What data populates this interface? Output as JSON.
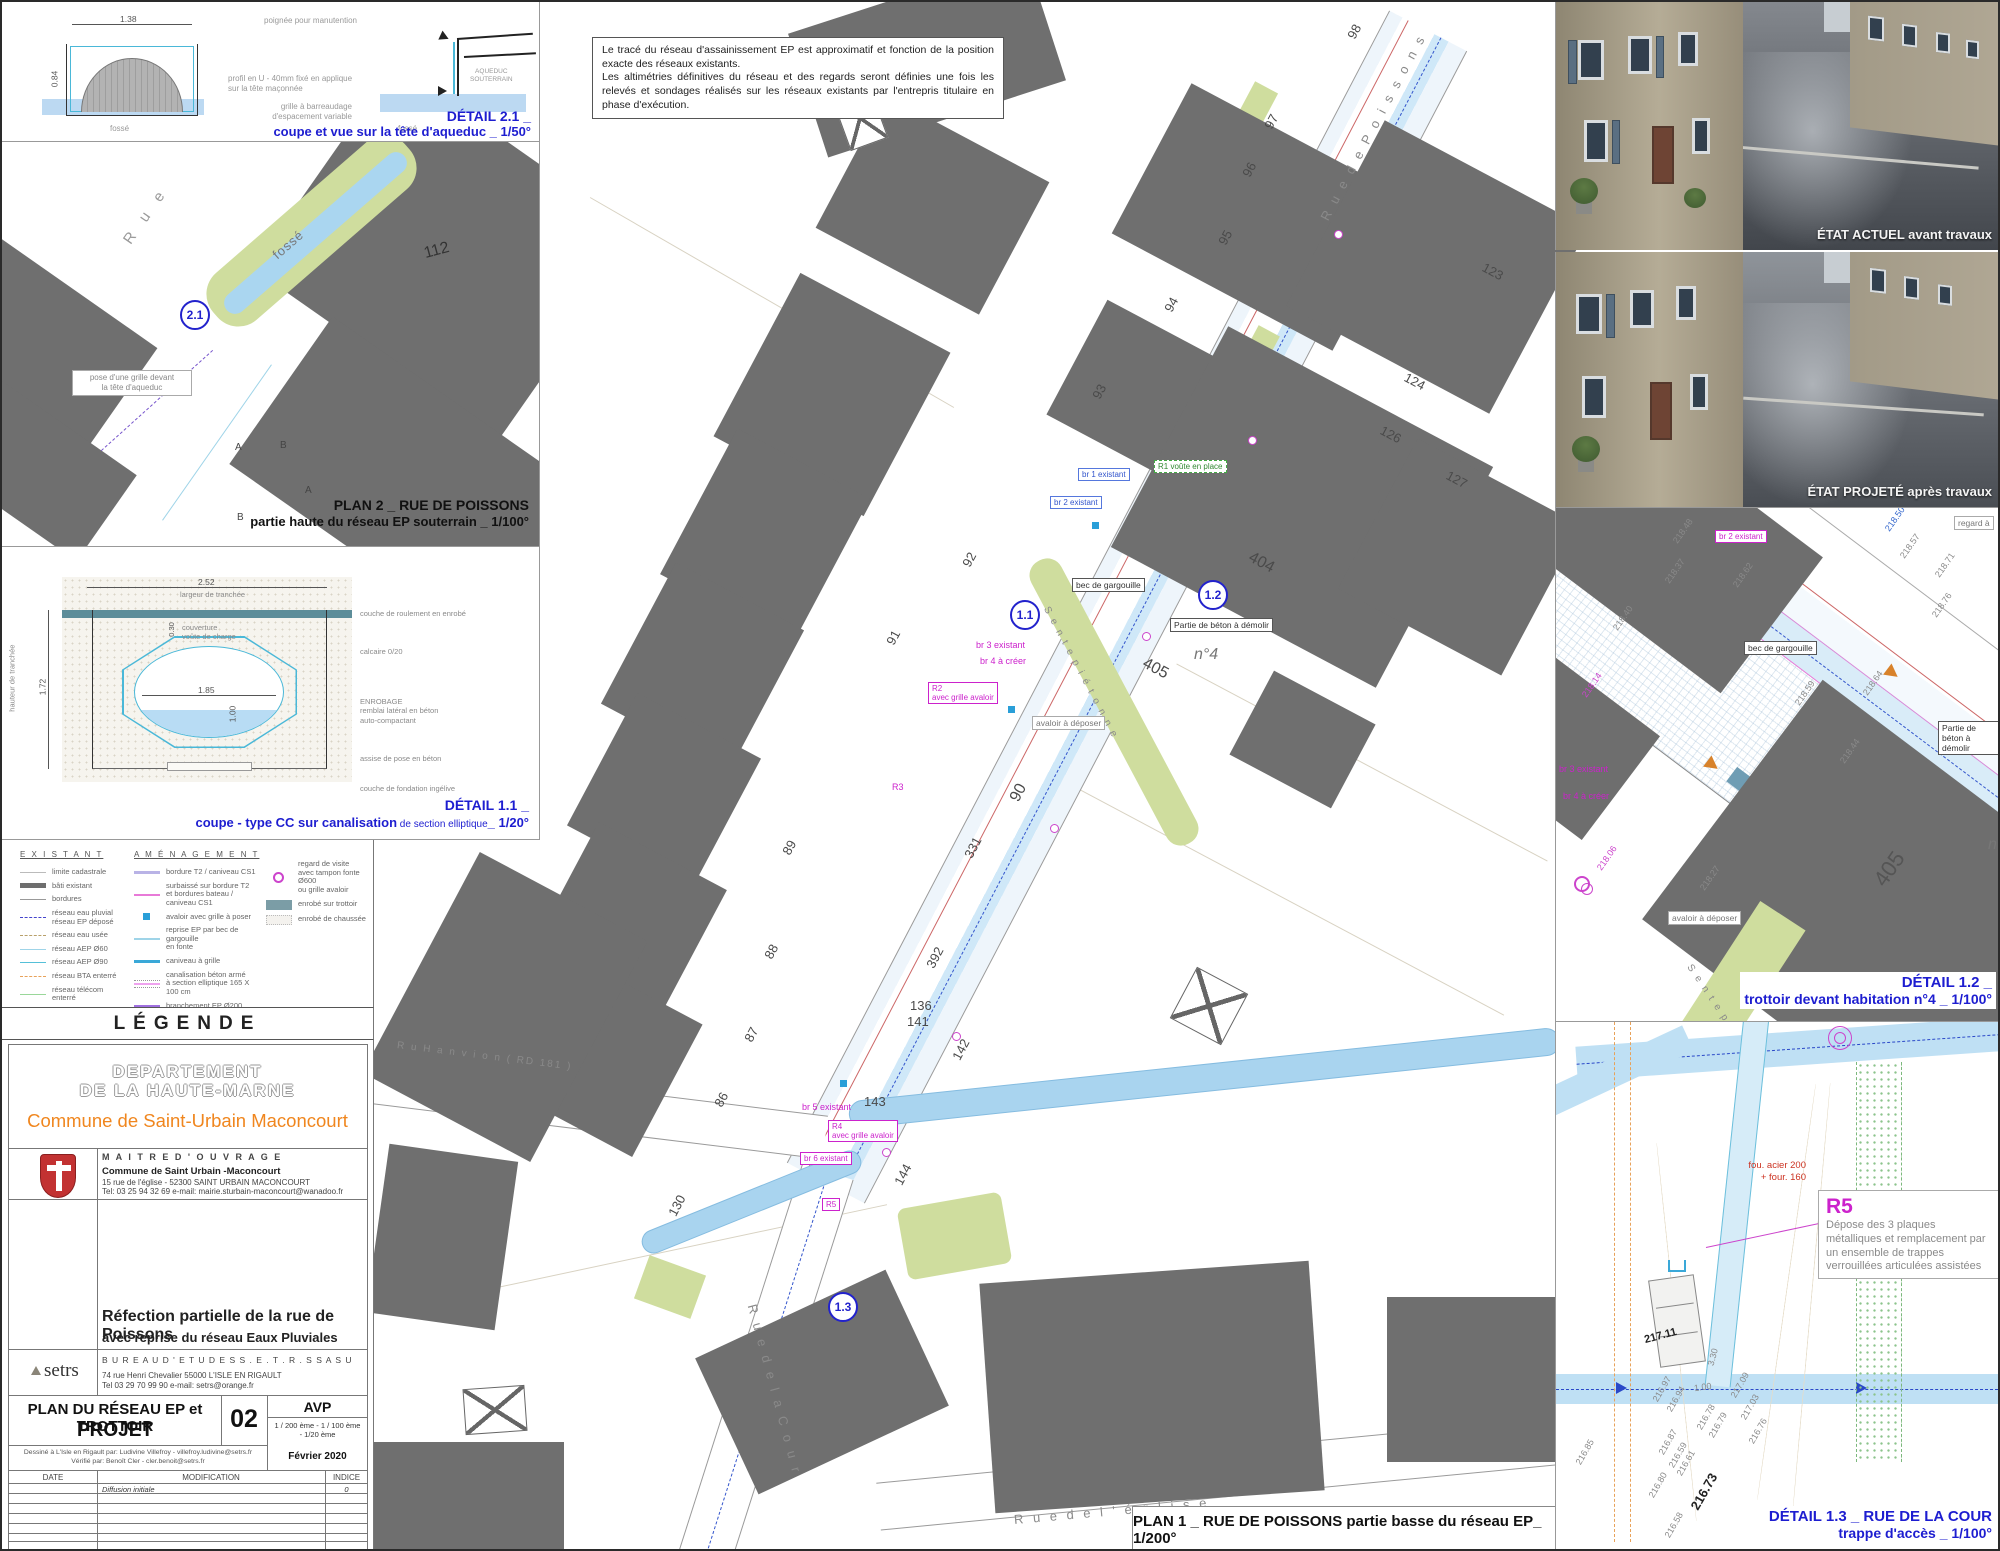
{
  "colors": {
    "caption_blue": "#1d1dd0",
    "magenta": "#cc22cc",
    "building_gray": "#6f6f6f",
    "water_blue": "#a9d4ef",
    "green": "#cfdd9e",
    "orange_brand": "#f0861e"
  },
  "note": {
    "line1": "Le tracé du réseau d'assainissement EP est approximatif et fonction de la position exacte des réseaux existants.",
    "line2": "Les altimétries définitives du réseau et des regards seront définies une fois les relevés et sondages réalisés sur les réseaux existants par l'entrepris titulaire en phase d'exécution."
  },
  "detail21": {
    "title": "DÉTAIL 2.1 _",
    "subtitle": "coupe et vue sur la tête d'aqueduc _ 1/50°",
    "dim_width": "1.38",
    "dim_height": "0.84",
    "lbl_poignee": "poignée pour manutention",
    "lbl_profil": "profil en U - 40mm fixé en applique\nsur la tête maçonnée",
    "lbl_grille": "grille à barreaudage\nd'espacement variable",
    "lbl_fosse1": "fossé",
    "lbl_fosse2": "fossé",
    "lbl_aqueduc": "AQUEDUC\nSOUTERRAIN"
  },
  "plan2": {
    "title": "PLAN 2 _ RUE DE POISSONS",
    "subtitle": "partie haute du réseau EP souterrain _ 1/100°",
    "circle": "2.1",
    "rue": "R u e",
    "fosse": "fossé",
    "parcel": "112",
    "callout": "pose d'une grille devant\nla tête d'aqueduc",
    "marks": [
      {
        "t": "A",
        "x": 233,
        "y": 300
      },
      {
        "t": "B",
        "x": 278,
        "y": 298
      },
      {
        "t": "B",
        "x": 235,
        "y": 370
      },
      {
        "t": "A",
        "x": 303,
        "y": 343
      }
    ]
  },
  "detail11": {
    "title": "DÉTAIL 1.1 _",
    "subtitle_bold": "coupe - type CC sur canalisation",
    "subtitle_small": " de section elliptique",
    "subtitle_scale": "_ 1/20°",
    "dim_top": "2.52",
    "dim_top_label": "largeur de tranchée",
    "dim_left": "1.72",
    "dim_left_label": "hauteur de tranchée",
    "dim_cover": "0.30",
    "cover_label": "couverture\nvoûte de charge",
    "dim_inner_w": "1.85",
    "dim_inner_h": "1.00",
    "right_labels": [
      {
        "t": "couche de roulement en enrobé",
        "x": 358,
        "y": 62
      },
      {
        "t": "calcaire 0/20",
        "x": 358,
        "y": 100
      },
      {
        "t": "ENROBAGE\nremblai latéral en  béton\nauto-compactant",
        "x": 358,
        "y": 150
      },
      {
        "t": "assise de pose en béton",
        "x": 358,
        "y": 207
      },
      {
        "t": "couche de fondation ingélive",
        "x": 358,
        "y": 237
      }
    ]
  },
  "legend": {
    "title": "LÉGENDE",
    "col1_title": "E X I S T A N T",
    "col2_title": "A M É N A G E M E N T",
    "existant": [
      {
        "label": "limite cadastrale",
        "sw": "sw-limite"
      },
      {
        "label": "bâti existant",
        "sw": "sw-bati"
      },
      {
        "label": "bordures",
        "sw": "sw-bordures"
      },
      {
        "label": "réseau eau pluvial\nréseau EP déposé",
        "sw": "sw-ep"
      },
      {
        "label": "réseau eau usée",
        "sw": "sw-eu"
      },
      {
        "label": "réseau AEP Ø60",
        "sw": "sw-aep60"
      },
      {
        "label": "réseau AEP Ø90",
        "sw": "sw-aep90"
      },
      {
        "label": "réseau BTA enterré",
        "sw": "sw-bta"
      },
      {
        "label": "réseau télécom enterré",
        "sw": "sw-telecom"
      },
      {
        "label": "réseau gaz",
        "sw": "sw-gaz"
      }
    ],
    "amenagement": [
      {
        "label": "bordure T2 / caniveau CS1",
        "sw": "sw-t2"
      },
      {
        "label": "surbaissé sur bordure T2\net bordures bateau / caniveau CS1",
        "sw": "sw-surbaisse"
      },
      {
        "label": "avaloir avec grille à poser",
        "sw": "sw-avaloir"
      },
      {
        "label": "reprise EP par bec de gargouille\nen fonte",
        "sw": "sw-reprise"
      },
      {
        "label": "caniveau à grille",
        "sw": "sw-caniveau"
      },
      {
        "label": "canalisation béton armé\nà section elliptique 165 X 100 cm",
        "sw": "sw-canal"
      },
      {
        "label": "branchement EP Ø200",
        "sw": "sw-branchement"
      }
    ],
    "surfaces": [
      {
        "label": "regard de visite\navec tampon fonte Ø600\nou grille avaloir",
        "sw": "sw-regard"
      },
      {
        "label": "enrobé sur trottoir",
        "sw": "sw-enrobe-trottoir"
      },
      {
        "label": "enrobé de chaussée",
        "sw": "sw-enrobe-chaussee"
      }
    ]
  },
  "titleblock": {
    "dept1": "DEPARTEMENT",
    "dept2": "DE LA HAUTE-MARNE",
    "commune": "Commune de Saint-Urbain Maconcourt",
    "moa_title": "M A I T R E   D ' O U V R A G E",
    "moa_name": "Commune de Saint Urbain -Maconcourt",
    "moa_addr": "15 rue de l'église - 52300 SAINT URBAIN MACONCOURT",
    "moa_tel": "Tel: 03 25 94 32 69    e-mail: mairie.sturbain-maconcourt@wanadoo.fr",
    "project1": "Réfection partielle de la rue de Poissons",
    "project2": "avec reprise du réseau Eaux Pluviales",
    "be_logo": "setrs",
    "be_title": "B U R E A U   D ' E T U D E S   S . E . T . R . S   S A S U",
    "be_addr": "74 rue Henri Chevalier   55000 L'ISLE EN RIGAULT",
    "be_tel": "Tel 03 29 70 99 90    e-mail: setrs@orange.fr",
    "plan_title1": "PLAN DU RÉSEAU EP et TROTTOIR",
    "plan_title2": "PROJET",
    "sheet_no": "02",
    "phase": "AVP",
    "scales1": "1 / 200 ème - 1 / 100 ème",
    "scales2": "- 1/20 ème",
    "drawn": "Dessiné à L'Isle en Rigault par:   Ludivine Villefroy   -   villefroy.ludivine@setrs.fr",
    "checked": "Vérifié par:   Benoît Cler   -   cler.benoit@setrs.fr",
    "date": "Février 2020",
    "th_date": "DATE",
    "th_modif": "MODIFICATION",
    "th_indice": "INDICE",
    "row1_modif": "Diffusion initiale",
    "row1_indice": "0"
  },
  "photos": {
    "caption1": "ÉTAT ACTUEL avant travaux",
    "caption2": "ÉTAT PROJETÉ après travaux"
  },
  "plan1": {
    "caption": "PLAN 1 _ RUE DE POISSONS partie basse du réseau EP_ 1/200°",
    "circles": [
      {
        "t": "1.1",
        "x": 1008,
        "y": 598
      },
      {
        "t": "1.2",
        "x": 1196,
        "y": 578
      },
      {
        "t": "1.3",
        "x": 826,
        "y": 1290
      }
    ],
    "streets": [
      {
        "t": "R u e   d e   P o i s s o n s",
        "x": 1322,
        "y": 210,
        "r": -62,
        "c": "street"
      },
      {
        "t": "S e n t e   p i é t o n n e",
        "x": 1044,
        "y": 600,
        "r": 62,
        "c": "street-sm"
      },
      {
        "t": "R u e   d e   l a   C o u r",
        "x": 750,
        "y": 1295,
        "r": 75,
        "c": "street"
      },
      {
        "t": "R u e   d e   l ' é g l i s e",
        "x": 1012,
        "y": 1510,
        "r": -5,
        "c": "street"
      },
      {
        "t": "R u   H a n v i o n   ( RD 181 )",
        "x": 395,
        "y": 1038,
        "r": 7,
        "c": "street-sm"
      }
    ],
    "parcels": [
      {
        "t": "98",
        "x": 1345,
        "y": 22,
        "r": -62
      },
      {
        "t": "97",
        "x": 1262,
        "y": 112,
        "r": -62
      },
      {
        "t": "96",
        "x": 1240,
        "y": 160,
        "r": -62
      },
      {
        "t": "95",
        "x": 1216,
        "y": 228,
        "r": -62
      },
      {
        "t": "94",
        "x": 1162,
        "y": 295,
        "r": -62
      },
      {
        "t": "93",
        "x": 1090,
        "y": 382,
        "r": -62
      },
      {
        "t": "92",
        "x": 960,
        "y": 550,
        "r": -62
      },
      {
        "t": "91",
        "x": 884,
        "y": 628,
        "r": -62
      },
      {
        "t": "90",
        "x": 1008,
        "y": 782,
        "r": -62,
        "c": "big"
      },
      {
        "t": "89",
        "x": 780,
        "y": 838,
        "r": -62
      },
      {
        "t": "88",
        "x": 762,
        "y": 942,
        "r": -62
      },
      {
        "t": "87",
        "x": 742,
        "y": 1025,
        "r": -62
      },
      {
        "t": "86",
        "x": 712,
        "y": 1090,
        "r": -62
      },
      {
        "t": "123",
        "x": 1480,
        "y": 262,
        "r": 28
      },
      {
        "t": "124",
        "x": 1402,
        "y": 372,
        "r": 28
      },
      {
        "t": "126",
        "x": 1378,
        "y": 425,
        "r": 28
      },
      {
        "t": "127",
        "x": 1444,
        "y": 470,
        "r": 28
      },
      {
        "t": "404",
        "x": 1246,
        "y": 552,
        "r": 28,
        "c": "big"
      },
      {
        "t": "405",
        "x": 1140,
        "y": 658,
        "r": 28,
        "c": "big"
      },
      {
        "t": "331",
        "x": 960,
        "y": 838,
        "r": -62
      },
      {
        "t": "392",
        "x": 922,
        "y": 948,
        "r": -62
      },
      {
        "t": "136",
        "x": 908,
        "y": 996
      },
      {
        "t": "141",
        "x": 905,
        "y": 1012
      },
      {
        "t": "142",
        "x": 948,
        "y": 1040,
        "r": -62
      },
      {
        "t": "143",
        "x": 862,
        "y": 1092
      },
      {
        "t": "144",
        "x": 890,
        "y": 1165,
        "r": -62
      },
      {
        "t": "130",
        "x": 664,
        "y": 1196,
        "r": -62
      }
    ],
    "labels": [
      {
        "t": "bec de gargouille",
        "x": 1070,
        "y": 576,
        "c": "box-label"
      },
      {
        "t": "Partie de béton à démolir",
        "x": 1168,
        "y": 616,
        "c": "box-label"
      },
      {
        "t": "n°4",
        "x": 1192,
        "y": 644,
        "c": "big-italic"
      },
      {
        "t": "br 2 existant",
        "x": 1048,
        "y": 494,
        "c": "box-blue"
      },
      {
        "t": "br 1 existant",
        "x": 1076,
        "y": 466,
        "c": "box-blue"
      },
      {
        "t": "R1\nvoûte en place",
        "x": 1152,
        "y": 458,
        "c": "box-green"
      },
      {
        "t": "br 3 existant",
        "x": 974,
        "y": 638,
        "c": "mag"
      },
      {
        "t": "br 4 à créer",
        "x": 978,
        "y": 654,
        "c": "mag"
      },
      {
        "t": "R2\navec grille avaloir",
        "x": 926,
        "y": 680,
        "c": "box-mag"
      },
      {
        "t": "avaloir à déposer",
        "x": 1030,
        "y": 714,
        "c": "box-gray"
      },
      {
        "t": "R3",
        "x": 890,
        "y": 780,
        "c": "mag"
      },
      {
        "t": "R4\navec grille avaloir",
        "x": 826,
        "y": 1118,
        "c": "box-mag"
      },
      {
        "t": "br 5 existant",
        "x": 800,
        "y": 1100,
        "c": "mag"
      },
      {
        "t": "br 6 existant",
        "x": 798,
        "y": 1150,
        "c": "box-mag"
      },
      {
        "t": "R5",
        "x": 820,
        "y": 1196,
        "c": "box-mag"
      }
    ]
  },
  "detail12": {
    "title": "DÉTAIL 1.2  _",
    "subtitle": "trottoir devant habitation n°4 _ 1/100°",
    "labels": [
      {
        "t": "br 2 existant",
        "x": 159,
        "y": 22,
        "c": "box-mag"
      },
      {
        "t": "regard à",
        "x": 398,
        "y": 8,
        "c": "box-gray"
      },
      {
        "t": "bec de gargouille",
        "x": 188,
        "y": 133,
        "c": "box-label"
      },
      {
        "t": "Partie de béton à démolir",
        "x": 382,
        "y": 213,
        "c": "box-label"
      },
      {
        "t": "br 3 existant",
        "x": 3,
        "y": 256,
        "c": "mag"
      },
      {
        "t": "br 4 à créer",
        "x": 7,
        "y": 283,
        "c": "mag"
      },
      {
        "t": "avaloir à déposer",
        "x": 112,
        "y": 403,
        "c": "box-gray"
      },
      {
        "t": "405",
        "x": 315,
        "y": 348,
        "r": -55,
        "c": "parcel-big"
      },
      {
        "t": "n",
        "x": 432,
        "y": 328,
        "c": "big-italic"
      },
      {
        "t": "S e n t e   p i é t o n n e",
        "x": 133,
        "y": 452,
        "r": 56,
        "c": "street-sm"
      }
    ],
    "elevations": [
      {
        "t": "218.14",
        "x": 22,
        "y": 172,
        "r": -55,
        "c": "elev-mag"
      },
      {
        "t": "218.37",
        "x": 105,
        "y": 58,
        "r": -55
      },
      {
        "t": "218.40",
        "x": 53,
        "y": 105,
        "r": -55
      },
      {
        "t": "218.48",
        "x": 113,
        "y": 18,
        "r": -55
      },
      {
        "t": "218.50",
        "x": 325,
        "y": 6,
        "r": -55,
        "c": "elev-blue"
      },
      {
        "t": "218.57",
        "x": 340,
        "y": 33,
        "r": -55
      },
      {
        "t": "218.62",
        "x": 173,
        "y": 62,
        "r": -55
      },
      {
        "t": "218.59",
        "x": 235,
        "y": 180,
        "r": -55
      },
      {
        "t": "218.64",
        "x": 303,
        "y": 170,
        "r": -55
      },
      {
        "t": "218.71",
        "x": 375,
        "y": 52,
        "r": -55
      },
      {
        "t": "218.76",
        "x": 372,
        "y": 92,
        "r": -55
      },
      {
        "t": "218.44",
        "x": 280,
        "y": 238,
        "r": -55
      },
      {
        "t": "218.06",
        "x": 37,
        "y": 345,
        "r": -55,
        "c": "elev-mag"
      },
      {
        "t": "218.27",
        "x": 140,
        "y": 365,
        "r": -55
      }
    ]
  },
  "detail13": {
    "title1": "DÉTAIL 1.3  _  RUE DE LA COUR",
    "title2": "trappe d'accès _ 1/100°",
    "r5_title": "R5",
    "r5_text": "Dépose des 3 plaques métalliques et remplacement par un ensemble de trappes verrouillées articulées assistées",
    "red_label": "fou. acier 200\n+ four. 160",
    "elevations": [
      {
        "t": "216.85",
        "x": 15,
        "y": 425,
        "r": -60
      },
      {
        "t": "216.80",
        "x": 88,
        "y": 458,
        "r": -60
      },
      {
        "t": "216.73",
        "x": 128,
        "y": 462,
        "r": -60,
        "c": "elev-big"
      },
      {
        "t": "216.87",
        "x": 98,
        "y": 415,
        "r": -60
      },
      {
        "t": "216.59",
        "x": 108,
        "y": 428,
        "r": -60
      },
      {
        "t": "216.61",
        "x": 116,
        "y": 436,
        "r": -60
      },
      {
        "t": "216.58",
        "x": 104,
        "y": 498,
        "r": -60
      },
      {
        "t": "216.97",
        "x": 92,
        "y": 362,
        "r": -60
      },
      {
        "t": "216.94",
        "x": 106,
        "y": 372,
        "r": -60
      },
      {
        "t": "216.78",
        "x": 136,
        "y": 390,
        "r": -60
      },
      {
        "t": "216.79",
        "x": 148,
        "y": 398,
        "r": -60
      },
      {
        "t": "217.11",
        "x": 88,
        "y": 308,
        "r": -15,
        "c": "elev-bold"
      },
      {
        "t": "1.00",
        "x": 138,
        "y": 360,
        "r": -8
      },
      {
        "t": "3.30",
        "x": 148,
        "y": 330,
        "r": -75
      },
      {
        "t": "217.03",
        "x": 180,
        "y": 380,
        "r": -60
      },
      {
        "t": "216.76",
        "x": 188,
        "y": 404,
        "r": -60
      },
      {
        "t": "217.09",
        "x": 170,
        "y": 358,
        "r": -60
      }
    ]
  }
}
